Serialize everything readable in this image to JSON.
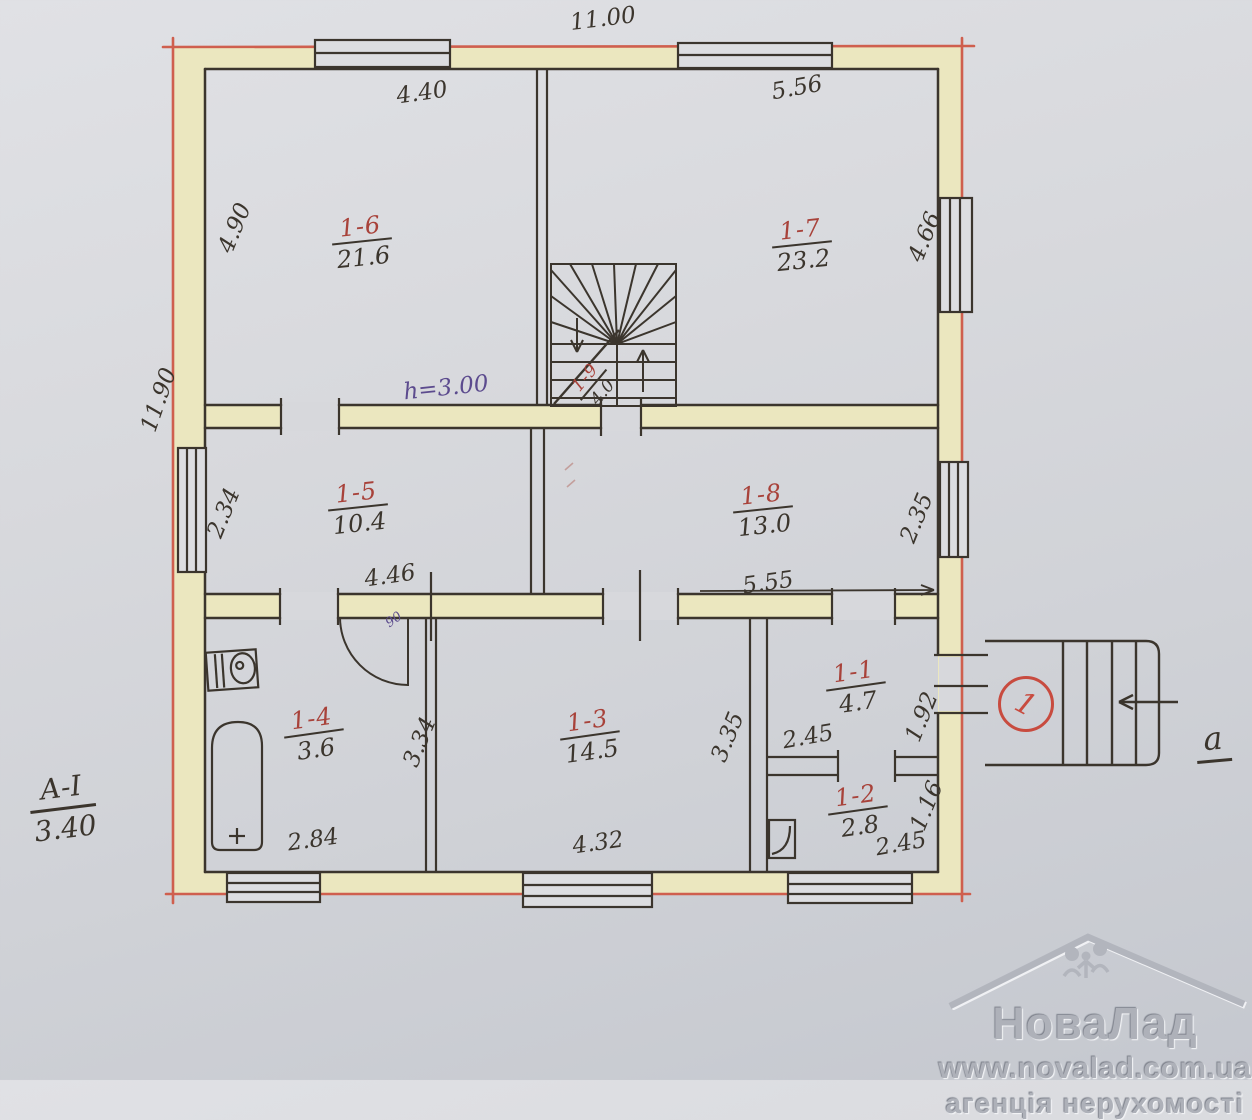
{
  "document": {
    "kind": "hand-drawn apartment floor plan sketch"
  },
  "plan": {
    "overall_width": "11.00",
    "overall_height": "11.90",
    "ceiling_height_note": "h=3.00",
    "door_width_note": "90",
    "section_mark": {
      "label": "А-І",
      "value": "3.40"
    },
    "entrance": {
      "circle_number": "1",
      "axis_letter": "а"
    },
    "stairs": {
      "id": "1-9",
      "area": "4.0"
    },
    "rooms": {
      "r1": {
        "id": "1-1",
        "area": "4.7",
        "width": "2.45",
        "depth": "1.92"
      },
      "r2": {
        "id": "1-2",
        "area": "2.8",
        "width": "2.45",
        "depth": "1.16"
      },
      "r3": {
        "id": "1-3",
        "area": "14.5",
        "width": "4.32",
        "depth": "3.35"
      },
      "r4": {
        "id": "1-4",
        "area": "3.6",
        "width": "2.84",
        "depth": "3.34"
      },
      "r5": {
        "id": "1-5",
        "area": "10.4",
        "width": "4.46",
        "depth": "2.34"
      },
      "r6": {
        "id": "1-6",
        "area": "21.6",
        "width": "4.40",
        "depth": "4.90"
      },
      "r7": {
        "id": "1-7",
        "area": "23.2",
        "width": "5.56",
        "depth": "4.66"
      },
      "r8": {
        "id": "1-8",
        "area": "13.0",
        "width": "5.55",
        "depth": "2.35"
      }
    }
  },
  "watermark": {
    "brand": "НоваЛад",
    "url": "www.novalad.com.ua",
    "tagline": "агенція нерухомості"
  },
  "colors": {
    "outer_wall_line": "#cf5f4e",
    "ink": "#3b352d",
    "room_number_ink": "#a8423a",
    "note_ink": "#5c4b8e",
    "wall_fill": "#ebe7bf",
    "paper": "#d6d7db"
  }
}
